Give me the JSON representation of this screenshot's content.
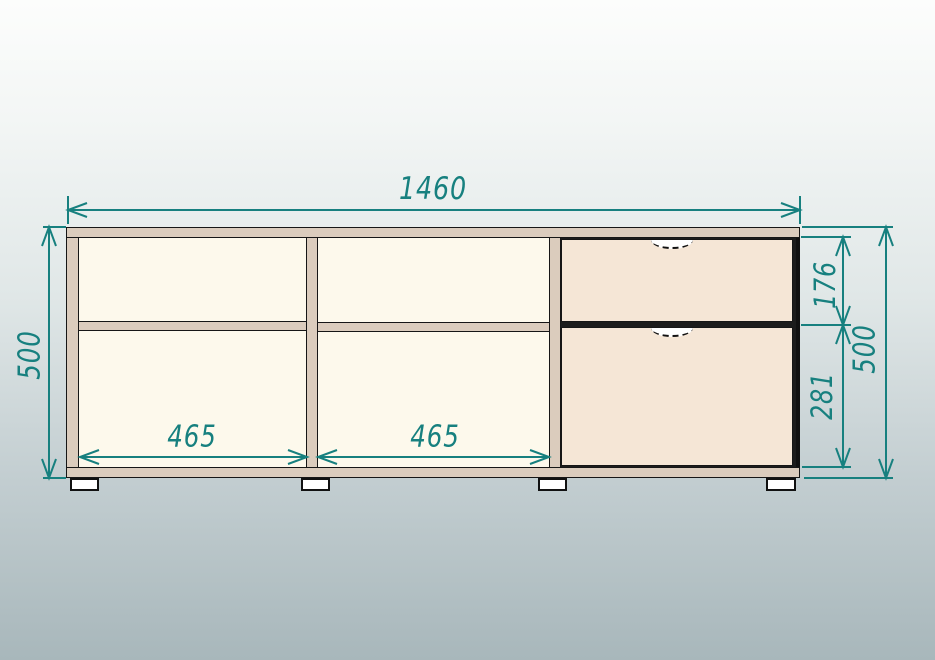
{
  "drawing": {
    "kind": "furniture-front-view-dimension-drawing",
    "dimensions": {
      "overall_width": "1460",
      "left_height": "500",
      "right_height": "500",
      "top_drawer_height": "176",
      "bottom_drawer_height": "281",
      "left_bay_width": "465",
      "middle_bay_width": "465"
    },
    "colors": {
      "dimension_accent": "#17807F",
      "carcass_panel": "#DBCCBD",
      "bay_interior": "#FDF9EC",
      "drawer_front": "#F5E6D6",
      "outline": "#161616",
      "background_top": "#FCFDFC",
      "background_bottom": "#A8B7BB"
    }
  }
}
